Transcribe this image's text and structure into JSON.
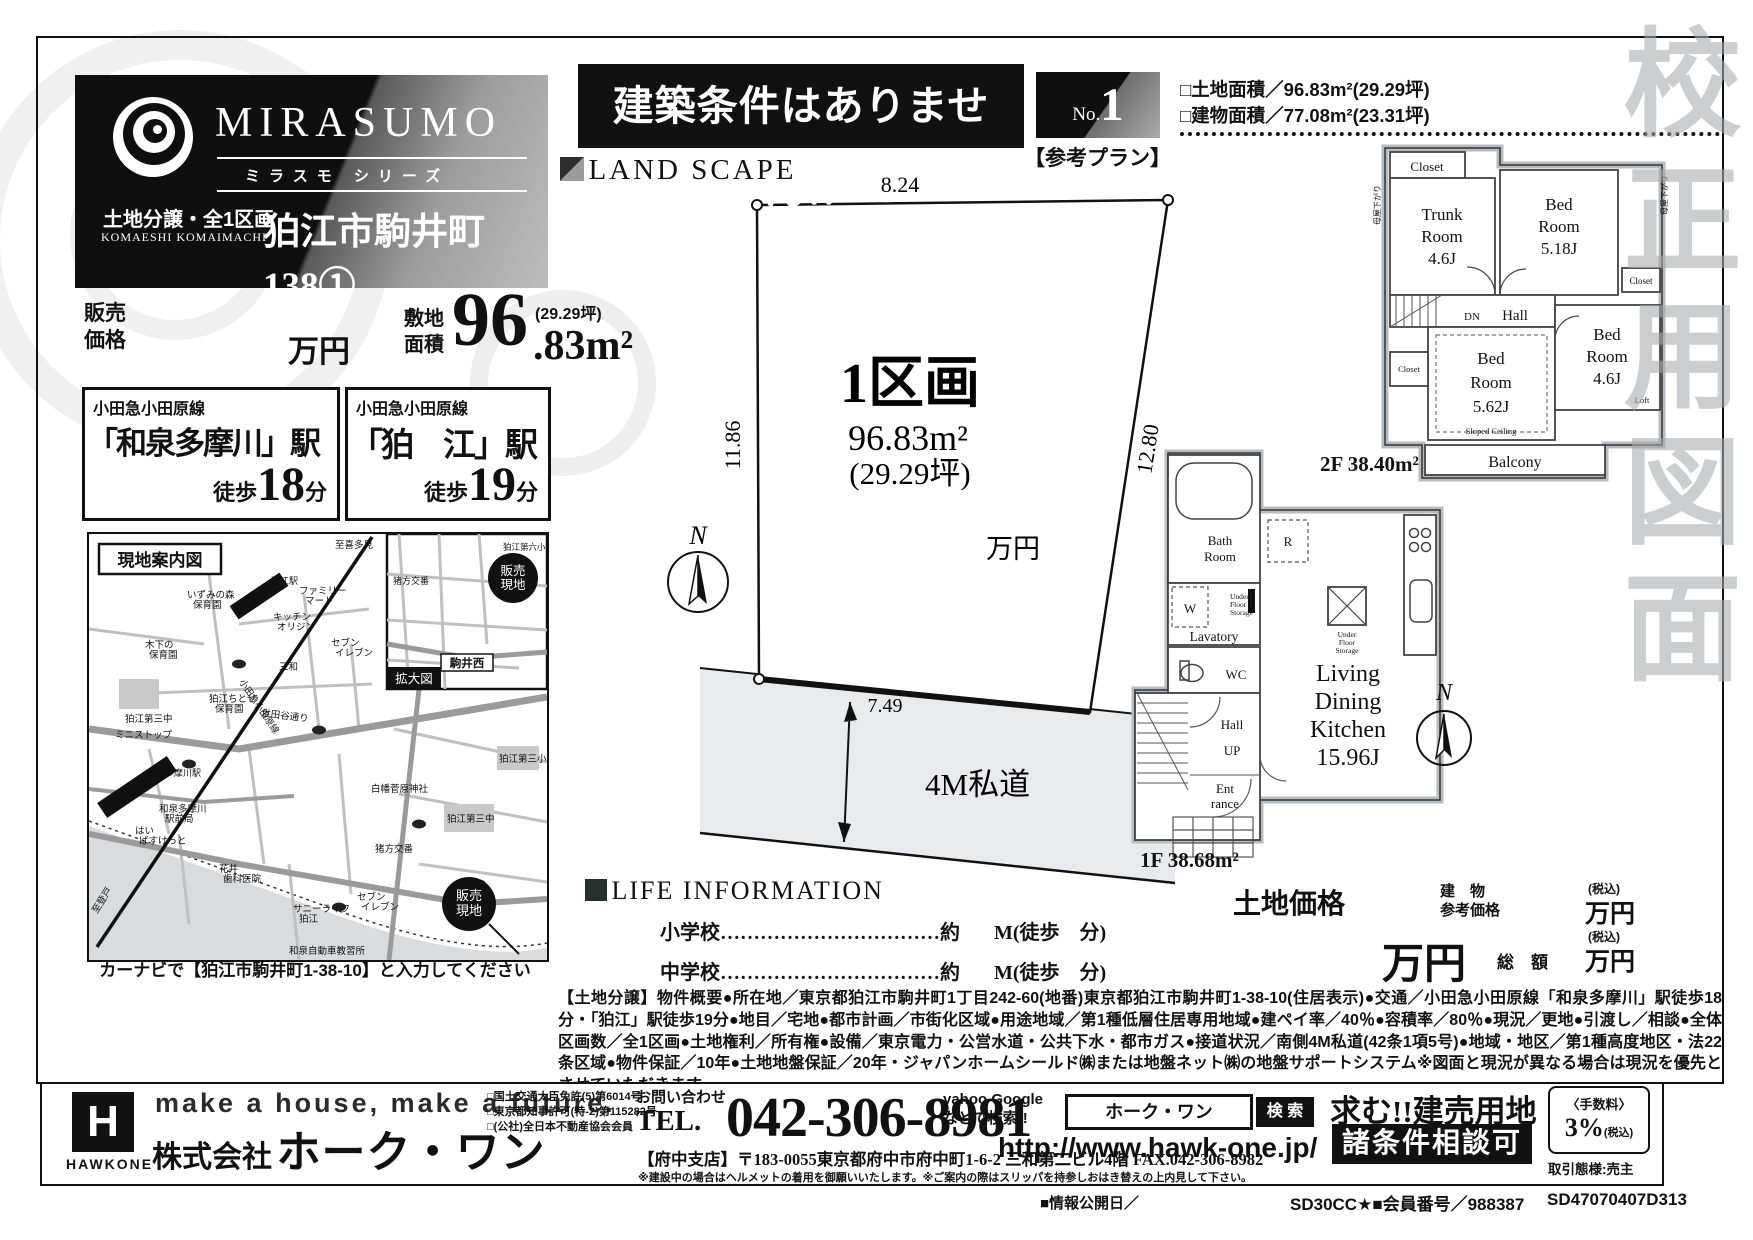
{
  "watermark": {
    "text": "校正用図面"
  },
  "brand": {
    "name": "MIRASUMO",
    "series": "ミラスモ シリーズ",
    "category": "土地分譲・全1区画",
    "romaji": "KOMAESHI KOMAIMACHI",
    "title": "狛江市駒井町138①"
  },
  "price": {
    "label1": "販売",
    "label2": "価格",
    "unit": "万円",
    "area_label1": "敷地",
    "area_label2": "面積",
    "area_big": "96",
    "area_small": ".83m²",
    "area_tsubo": "(29.29坪)"
  },
  "stations": [
    {
      "line": "小田急小田原線",
      "name": "「和泉多摩川」駅",
      "walk_prefix": "徒歩",
      "walk_min": "18",
      "walk_suffix": "分"
    },
    {
      "line": "小田急小田原線",
      "name": "「狛　江」駅",
      "walk_prefix": "徒歩",
      "walk_min": "19",
      "walk_suffix": "分"
    }
  ],
  "map": {
    "title": "現地案内図",
    "inset_tag": "拡大図",
    "site1": "販売",
    "site2": "現地",
    "caption": "カーナビで【狛江市駒井町1-38-10】と入力してください",
    "labels": {
      "kitami": "至喜多見",
      "izumi1": "いずみの森",
      "izumi2": "保育園",
      "famima1": "ファミリー",
      "famima2": "マート",
      "kitchen1": "キッチン",
      "kitchen2": "オリジン",
      "seven1": "セブン",
      "seven2": "イレブン",
      "sanwa": "三和",
      "kinoshita1": "木下の",
      "kinoshita2": "保育園",
      "dai3chu": "狛江第三中",
      "ministop": "ミニストップ",
      "chitose1": "狛江ちとせ",
      "chitose2": "保育園",
      "setagaya": "世田谷通り",
      "ekimae1": "和泉多摩川",
      "ekimae2": "駅前局",
      "basket1": "はい",
      "basket2": "ばすけっと",
      "hanai1": "花井",
      "hanai2": "歯科医院",
      "shirahata": "白幡菅原神社",
      "dai3sho": "狛江第三小",
      "dai3chu2": "狛江第三中",
      "sunny1": "サニーライフ",
      "sunny2": "狛江",
      "seven3": "セブン",
      "seven4": "イレブン",
      "inokata": "猪方交番",
      "noboto": "至登戸",
      "kyoshujo": "和泉自動車教習所",
      "dai6sho": "狛江第六小",
      "inokata2": "猪方交番",
      "komaiNishi": "駒井西",
      "station1": "狛江駅",
      "station2": "和泉多摩川駅",
      "line": "小田急小田原線"
    }
  },
  "banner": {
    "text": "建築条件はありません!!"
  },
  "landscape": {
    "heading": "LAND SCAPE",
    "plot_name": "1区画",
    "plot_area": "96.83m²",
    "plot_tsubo": "(29.29坪)",
    "plot_unit": "万円",
    "dim_top": "8.24",
    "dim_left": "11.86",
    "dim_right": "12.80",
    "dim_bottom": "7.49",
    "road": "4M私道",
    "north": "N"
  },
  "life": {
    "heading": "LIFE INFORMATION",
    "rows": [
      {
        "label": "小学校",
        "dots": "……………………………",
        "approx": "約",
        "unit": "M(徒歩　分)"
      },
      {
        "label": "中学校",
        "dots": "……………………………",
        "approx": "約",
        "unit": "M(徒歩　分)"
      }
    ]
  },
  "plan": {
    "no_label": "No.",
    "no_value": "1",
    "ref": "【参考プラン】",
    "land_area": "□土地面積／96.83m²(29.29坪)",
    "bldg_area": "□建物面積／77.08m²(23.31坪)",
    "f2": {
      "closet1": "Closet",
      "trunk": [
        "Trunk",
        "Room",
        "4.6J"
      ],
      "bed1": [
        "Bed",
        "Room",
        "5.18J"
      ],
      "closet2": "Closet",
      "dn": "DN",
      "hall": "Hall",
      "closet3": "Closet",
      "bed2": [
        "Bed",
        "Room",
        "5.62J"
      ],
      "sloped": "Sloped Ceiling",
      "bed3": [
        "Bed",
        "Room",
        "4.6J"
      ],
      "loft": "Loft",
      "balcony": "Balcony",
      "area": "2F 38.40m²",
      "hisashi": "母屋下がり"
    },
    "f1": {
      "bath": [
        "Bath",
        "Room"
      ],
      "w": "W",
      "ufs": [
        "Under",
        "Floor",
        "Storage"
      ],
      "lavatory": "Lavatory",
      "wc": "WC",
      "hall": "Hall",
      "up": "UP",
      "entrance": [
        "Ent",
        "rance"
      ],
      "r": "R",
      "ufs2": [
        "Under",
        "Floor",
        "Storage"
      ],
      "ldk": [
        "Living",
        "Dining",
        "Kitchen",
        "15.96J"
      ],
      "area": "1F 38.68m²",
      "north": "N"
    },
    "prices": {
      "land": "土地価格",
      "bldg1": "建　物",
      "bldg2": "参考価格",
      "tax1": "(税込)",
      "unit1": "万円",
      "big_unit": "万円",
      "total": "総　額",
      "tax2": "(税込)",
      "unit2": "万円"
    }
  },
  "overview": {
    "text": "【土地分譲】物件概要●所在地／東京都狛江市駒井町1丁目242-60(地番)東京都狛江市駒井町1-38-10(住居表示)●交通／小田急小田原線「和泉多摩川」駅徒歩18分・「狛江」駅徒歩19分●地目／宅地●都市計画／市街化区域●用途地域／第1種低層住居専用地域●建ペイ率／40％●容積率／80％●現況／更地●引渡し／相談●全体区画数／全1区画●土地権利／所有権●設備／東京電力・公営水道・公共下水・都市ガス●接道状況／南側4M私道(42条1項5号)●地域・地区／第1種高度地区・法22条区域●物件保証／10年●土地地盤保証／20年・ジャパンホームシールド㈱または地盤ネット㈱の地盤サポートシステム※図面と現況が異なる場合は現況を優先とさせていただきます。"
  },
  "footer": {
    "logo_letter": "H",
    "logo_name": "HAWKONE",
    "tagline": "make a house, make a future.",
    "company_prefix": "株式会社",
    "company_name": "ホーク・ワン",
    "licenses": [
      "□国土交通大臣免許(5)第6014号",
      "□東京都知事許可(特-2)第115282号",
      "□(公社)全日本不動産協会会員"
    ],
    "contact_label": "お問い合わせ",
    "tel_prefix": "TEL.",
    "tel": "042-306-8981",
    "branch": "【府中支店】〒183-0055東京都府中市府中町1-6-2 三和第二ビル4階 FAX.042-306-8982",
    "note": "※建設中の場合はヘルメットの着用を御願いいたします。※ご案内の際はスリッパを持参しおはき替えの上内見して下さい。",
    "search_hint1": "yahoo Google",
    "search_hint2": "などで検索!!",
    "search_word": "ホーク・ワン",
    "search_btn": "検 索",
    "url": "http://www.hawk-one.jp/",
    "seeking": "求む!!建売用地",
    "negotiable": "諸条件相談可",
    "fee_label": "〈手数料〉",
    "fee_value": "3%",
    "fee_tax": "(税込)",
    "dealing": "取引態様:売主"
  },
  "codes": {
    "info_date": "■情報公開日／",
    "member": "SD30CC★■会員番号／988387",
    "code": "SD47070407D313"
  }
}
